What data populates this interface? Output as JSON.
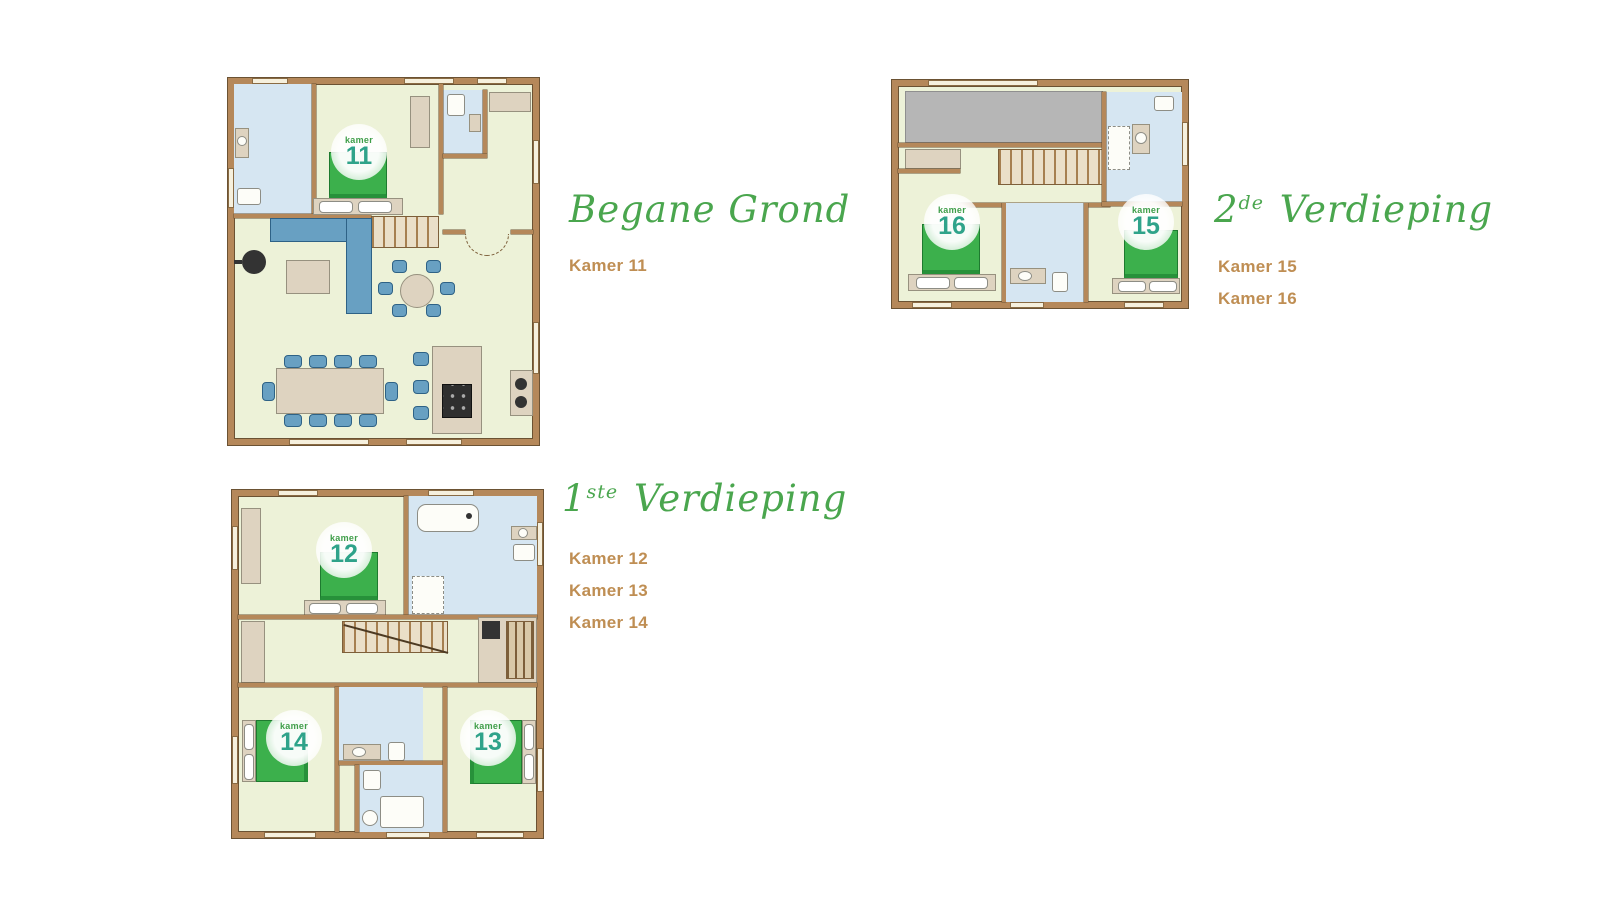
{
  "palette": {
    "background": "#ffffff",
    "title_green": "#4aa64e",
    "label_brown": "#bf8e53",
    "wall": "#b5885a",
    "wall_edge": "#6b5233",
    "floor": "#edf2d8",
    "bath": "#d6e6f2",
    "bed": "#3cb04c",
    "bed_edge": "#27913a",
    "blue": "#68a0c2",
    "tan": "#ded3c0",
    "gray": "#b6b6b6",
    "badge_number": "#2fa38a",
    "badge_word": "#3f9e49"
  },
  "floors": [
    {
      "id": "begane-grond",
      "title_number": "",
      "title_sup": "",
      "title_name": "Begane Grond",
      "rooms": [
        "Kamer 11"
      ]
    },
    {
      "id": "eerste-verdieping",
      "title_number": "1",
      "title_sup": "ste",
      "title_name": " Verdieping",
      "rooms": [
        "Kamer 12",
        "Kamer 13",
        "Kamer 14"
      ]
    },
    {
      "id": "tweede-verdieping",
      "title_number": "2",
      "title_sup": "de",
      "title_name": " Verdieping",
      "rooms": [
        "Kamer 15",
        "Kamer 16"
      ]
    }
  ],
  "badges": {
    "word": "kamer",
    "k11": "11",
    "k12": "12",
    "k13": "13",
    "k14": "14",
    "k15": "15",
    "k16": "16"
  }
}
